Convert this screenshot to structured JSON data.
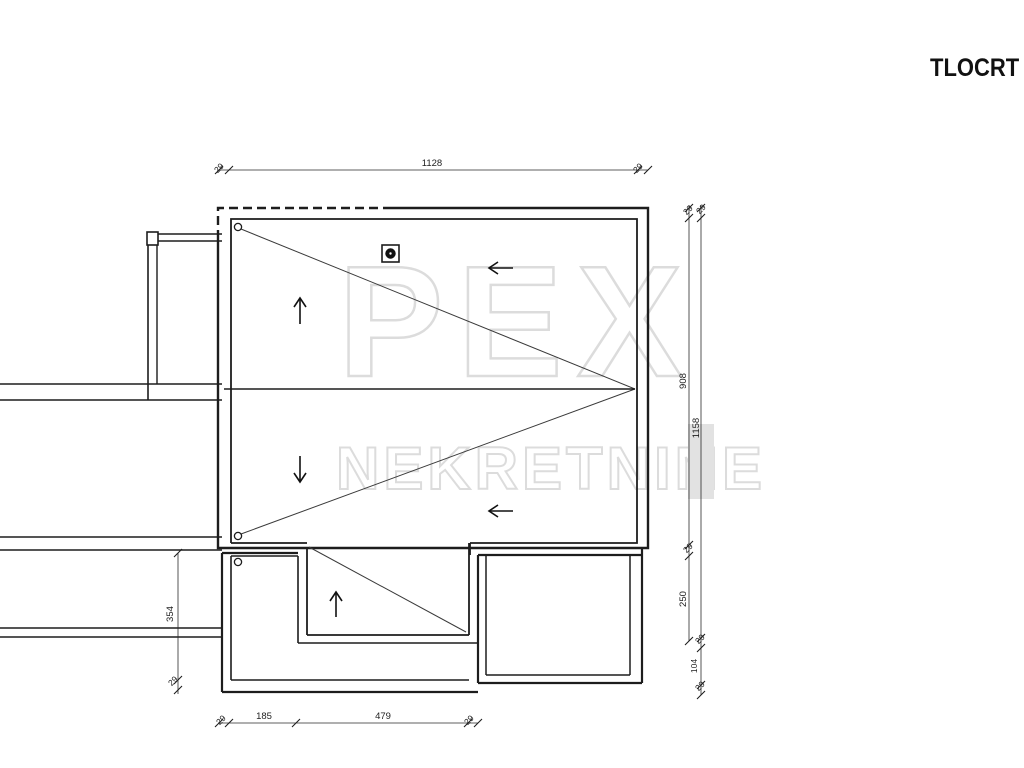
{
  "title": "TLOCRT K",
  "watermark": {
    "brand": "PEX",
    "subtitle": "NEKRETNINE"
  },
  "dimensions": {
    "top": {
      "left_overhang": "29",
      "width": "1128",
      "right_overhang": "29"
    },
    "right_inner": {
      "top_overhang": "29",
      "upper": "908",
      "mid_overhang": "29",
      "lower": "250"
    },
    "right_outer": {
      "top_overhang": "29",
      "total": "1158",
      "mid_overhang": "29",
      "lower": "104",
      "bottom_overhang": "29"
    },
    "left": {
      "height": "354",
      "overhang": "29"
    },
    "bottom": {
      "left_overhang": "29",
      "seg1": "185",
      "seg2": "479",
      "right_overhang": "29"
    }
  },
  "colors": {
    "line": "#1d1d1d",
    "watermark": "#dcdcdc",
    "chimney_fill": "#111111"
  }
}
